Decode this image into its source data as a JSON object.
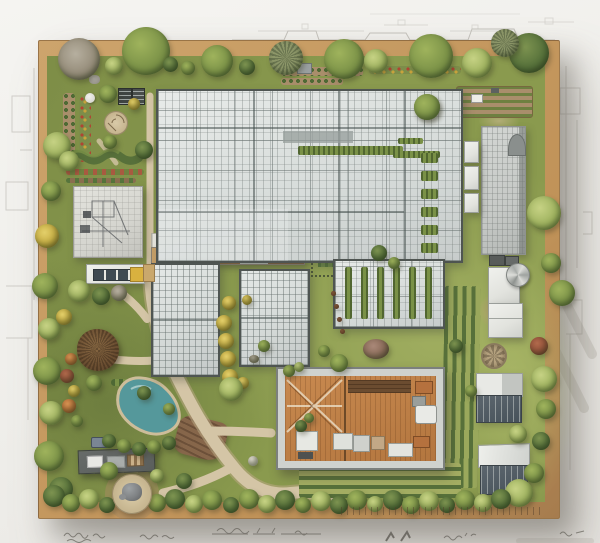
{
  "scene": {
    "labels": {
      "stage": "photograph of an architectural landscape model on sketch paper",
      "board": "square site-model board with wooden base edge",
      "main_greenhouse": "large gridded glasshouse complex",
      "greenhouse_left": "mid-size glasshouse left",
      "greenhouse_right": "mid-size glasshouse right",
      "sketch_building": "flat-roof building with pencil sketch on roof",
      "tall_building": "tall grey-roofed building at right",
      "open_building": "open-roof hall showing wooden interior with furniture",
      "pond": "small turquoise garden pond",
      "thatched_hut": "round thatched hut",
      "stone_circle": "circular stone rockery",
      "paths": "winding sandy garden paths",
      "perimeter_planting": "perimeter hedges and trees",
      "annotations": "illegible handwritten pencil notes below the board"
    }
  },
  "palette": {
    "paper": "#f5f4f1",
    "baseWood": "#cda46c",
    "baseWoodDark": "#a67c4e",
    "grass": "#8a9a4e",
    "hedgeLight": "#9fb35c",
    "hedgeMid": "#7a9147",
    "hedgeDark": "#57703a",
    "treeGray": "#938a77",
    "shrubYellow": "#c3a93e",
    "shrubOrange": "#bb7038",
    "shrubRust": "#96503a",
    "glassPane": "#e8ebe9",
    "glassShade": "#c7cccb",
    "glassFrame": "#4f5552",
    "roofLight": "#c6c9c6",
    "wallWhite": "#e2e3de",
    "windowDark": "#47525a",
    "woodFloor": "#c8894f",
    "pondWater": "#55989b",
    "pathSand": "#d4c5a6",
    "soil": "#a98e6b",
    "soilDark": "#86664a",
    "slateRoof": "#5a5e5c",
    "sketchLine": "#a9a6a0",
    "accentYellow": "#d9b13f",
    "brickTan": "#c9a26a"
  }
}
